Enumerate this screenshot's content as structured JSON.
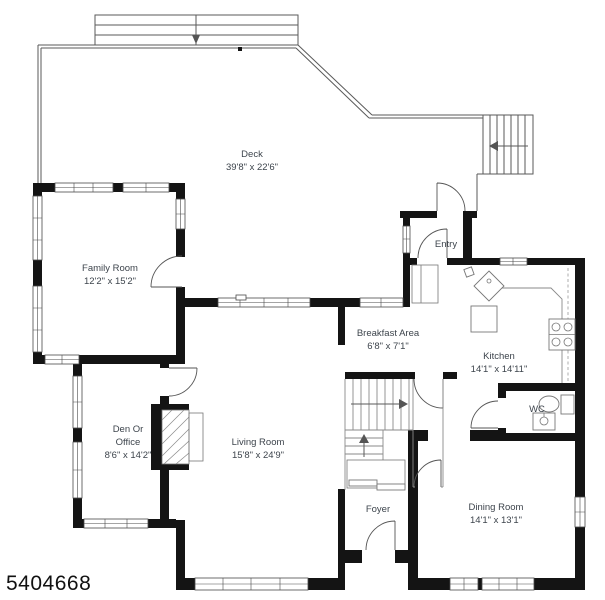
{
  "watermark": "5404668",
  "colors": {
    "wall": "#141414",
    "thin_line": "#5a5a5a",
    "label_text": "#3d444c",
    "background": "#ffffff"
  },
  "rooms": [
    {
      "id": "deck",
      "name": "Deck",
      "dims": "39'8\" x 22'6\""
    },
    {
      "id": "family-room",
      "name": "Family Room",
      "dims": "12'2\" x 15'2\""
    },
    {
      "id": "entry",
      "name": "Entry",
      "dims": ""
    },
    {
      "id": "breakfast-area",
      "name": "Breakfast Area",
      "dims": "6'8\" x 7'1\""
    },
    {
      "id": "kitchen",
      "name": "Kitchen",
      "dims": "14'1\" x 14'11\""
    },
    {
      "id": "den-or-office",
      "name": "Den Or Office",
      "name_lines": [
        "Den Or",
        "Office"
      ],
      "dims": "8'6\" x 14'2\""
    },
    {
      "id": "living-room",
      "name": "Living Room",
      "dims": "15'8\" x 24'9\""
    },
    {
      "id": "wc",
      "name": "WC",
      "dims": ""
    },
    {
      "id": "foyer",
      "name": "Foyer",
      "dims": ""
    },
    {
      "id": "dining-room",
      "name": "Dining Room",
      "dims": "14'1\" x 13'1\""
    }
  ]
}
